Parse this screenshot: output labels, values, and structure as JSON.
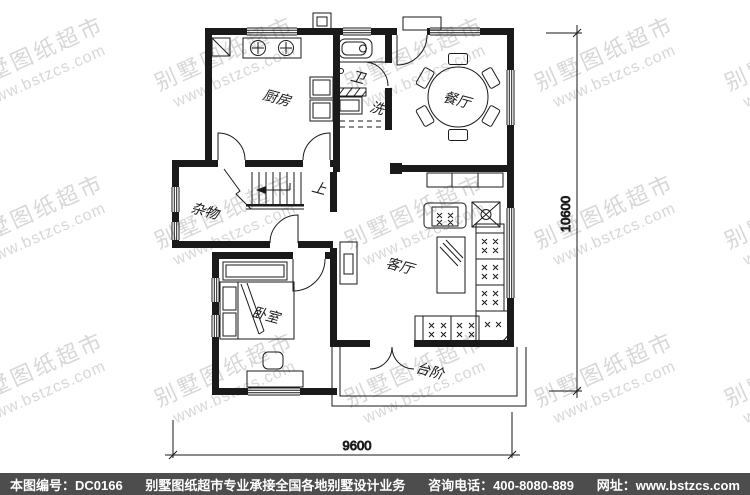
{
  "watermark": {
    "line1": "别墅图纸超市",
    "line2": "www.bstzcs.com",
    "color": "#d7d7d7"
  },
  "plan": {
    "rooms": {
      "kitchen": "厨房",
      "bath": "卫",
      "wash": "洗",
      "dining": "餐厅",
      "storage": "杂物",
      "stairs_up": "上",
      "living": "客厅",
      "bedroom": "卧室",
      "porch": "台阶"
    },
    "dimensions": {
      "width": "9600",
      "height": "10600"
    }
  },
  "footer": {
    "bg": "#4d4d4d",
    "drawing_no": "本图编号：DC0166",
    "slogan": "别墅图纸超市专业承接全国各地别墅设计业务",
    "phone": "咨询电话：400-8080-889",
    "website": "网址：www.bstzcs.com"
  }
}
